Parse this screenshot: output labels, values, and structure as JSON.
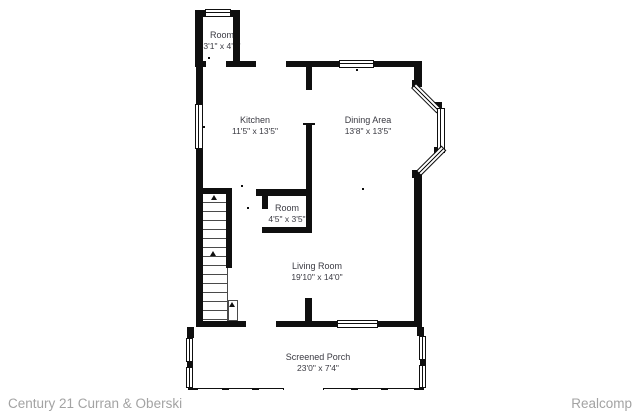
{
  "plan": {
    "rooms": [
      {
        "name": "Room",
        "dims": "3'1\" x 4'1\""
      },
      {
        "name": "Kitchen",
        "dims": "11'5\" x 13'5\""
      },
      {
        "name": "Dining Area",
        "dims": "13'8\" x 13'5\""
      },
      {
        "name": "Room",
        "dims": "4'5\" x 3'5\""
      },
      {
        "name": "Living Room",
        "dims": "19'10\" x 14'0\""
      },
      {
        "name": "Screened Porch",
        "dims": "23'0\" x 7'4\""
      }
    ]
  },
  "footer": {
    "left": "Century 21 Curran & Oberski",
    "right": "Realcomp"
  },
  "colors": {
    "wall": "#0f0f0f",
    "label": "#3a3a42",
    "footer_text": "#a3a3a3"
  }
}
